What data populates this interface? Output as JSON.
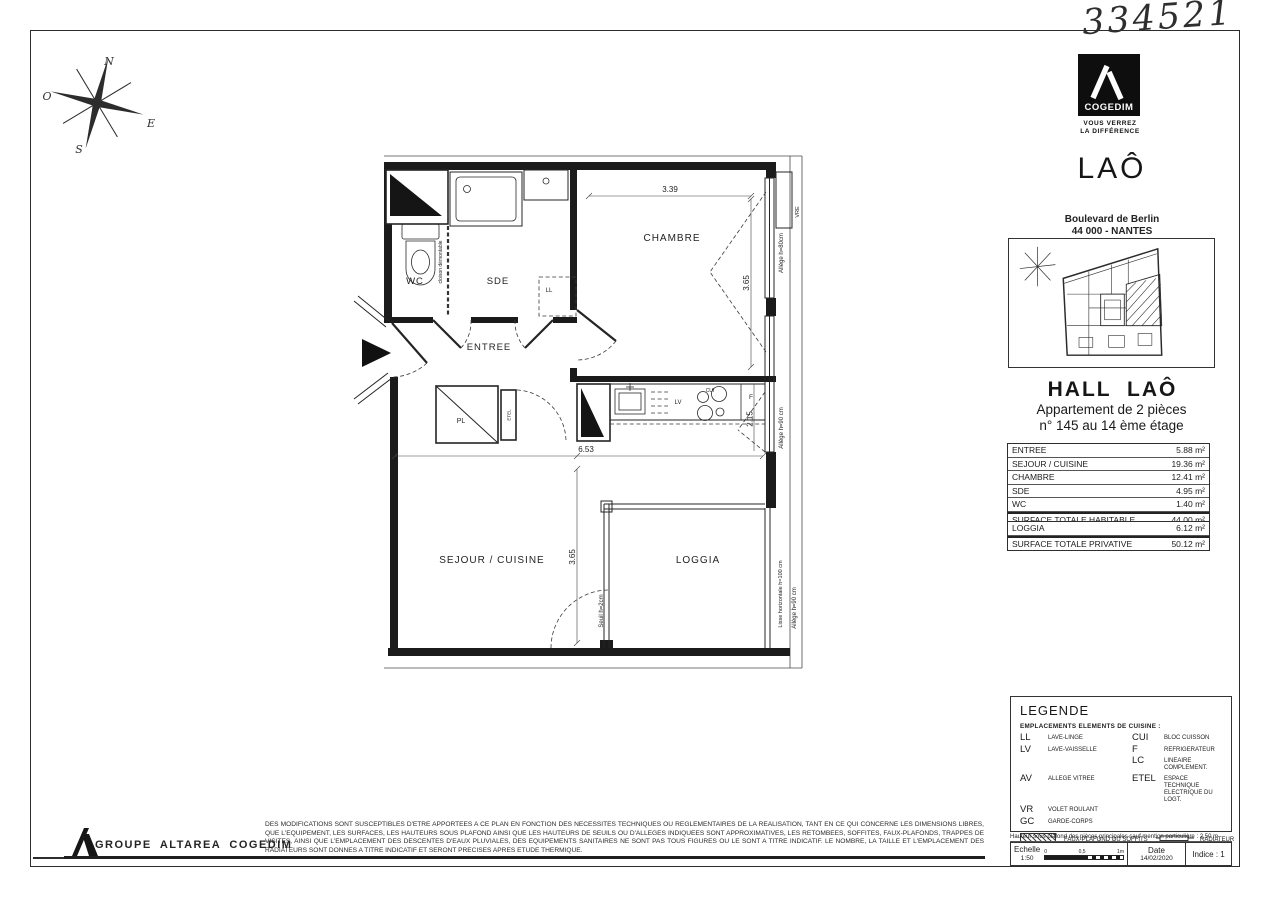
{
  "page": {
    "handwritten_number": "334521"
  },
  "compass": {
    "n": "N",
    "o": "O",
    "e": "E",
    "s": "S"
  },
  "plan": {
    "unit_label": "N°145",
    "rooms": {
      "wc": "WC",
      "sde": "SDE",
      "entree": "ENTREE",
      "chambre": "CHAMBRE",
      "sejour_cuisine": "SEJOUR / CUISINE",
      "loggia": "LOGGIA"
    },
    "fixtures": {
      "ll": "LL",
      "lv": "LV",
      "cui": "CUI",
      "f": "F",
      "pl": "PL",
      "etel": "ETEL",
      "vre": "VRE"
    },
    "annotations": {
      "cloison_demontable": "cloison démontable",
      "allege_80": "Allège h=80cm",
      "allege_90_kitchen": "Allège h=90 cm",
      "allege_90_loggia": "Allège h=90 cm",
      "lisse_horizontale": "Lisse horizontale h=100 cm",
      "seuil": "Seuil h=2cm"
    },
    "dimensions": {
      "chambre_width": "3.39",
      "chambre_height": "3.65",
      "sejour_width": "6.53",
      "kitchen_depth": "2.15",
      "sejour_height": "3.65"
    }
  },
  "sidebar": {
    "logo": {
      "brand": "COGEDIM",
      "tagline1": "VOUS VERREZ",
      "tagline2": "LA DIFFÉRENCE"
    },
    "residence": "LAÔ",
    "address1": "Boulevard de Berlin",
    "address2": "44 000 - NANTES",
    "hall": "HALL LAÔ",
    "apartment1": "Appartement de 2 pièces",
    "apartment2": "n° 145 au 14 ème étage",
    "surface_rows": [
      {
        "label": "ENTREE",
        "value": "5.88 m²"
      },
      {
        "label": "SEJOUR / CUISINE",
        "value": "19.36 m²"
      },
      {
        "label": "CHAMBRE",
        "value": "12.41 m²"
      },
      {
        "label": "SDE",
        "value": "4.95 m²"
      },
      {
        "label": "WC",
        "value": "1.40 m²"
      },
      {
        "label": "SURFACE TOTALE HABITABLE",
        "value": "44.00 m²"
      }
    ],
    "private_rows": [
      {
        "label": "LOGGIA",
        "value": "6.12 m²"
      },
      {
        "label": "SURFACE TOTALE PRIVATIVE",
        "value": "50.12 m²"
      }
    ],
    "legend": {
      "title": "LEGENDE",
      "subtitle": "EMPLACEMENTS ELEMENTS DE CUISINE :",
      "rows": [
        {
          "a": "LL",
          "al": "LAVE-LINGE",
          "b": "CUI",
          "bl": "BLOC CUISSON"
        },
        {
          "a": "LV",
          "al": "LAVE-VAISSELLE",
          "b": "F",
          "bl": "REFRIGERATEUR"
        },
        {
          "a": "",
          "al": "",
          "b": "LC",
          "bl": "LINEAIRE COMPLEMENT."
        },
        {
          "a": "AV",
          "al": "ALLEGE VITREE",
          "b": "ETEL",
          "bl": "ESPACE TECHNIQUE ELECTRIQUE DU LOGT."
        },
        {
          "a": "VR",
          "al": "VOLET ROULANT",
          "b": "",
          "bl": ""
        },
        {
          "a": "GC",
          "al": "GARDE-CORPS",
          "b": "",
          "bl": ""
        }
      ],
      "swatches": {
        "faux_plafond": "FAUX-PLAFOND OU SOFFITS",
        "radiateur": "RADIATEUR",
        "retombee": "RETOMBEE DE POUTRE",
        "seche": "SECHE-SERV."
      }
    },
    "ceiling_note": "Hauteur sous plafond des pièces principales sauf mention particulière : 2,50 m",
    "title_block": {
      "scale_label": "Echelle",
      "scale_value": "1:50",
      "scale_ticks": [
        "0",
        "0,5",
        "1m"
      ],
      "date_label": "Date",
      "date_value": "14/02/2020",
      "indice": "Indice : 1"
    }
  },
  "footer": {
    "company": "GROUPE ALTAREA COGEDIM",
    "disclaimer": "DES MODIFICATIONS SONT SUSCEPTIBLES D'ETRE APPORTEES A CE PLAN EN FONCTION DES NECESSITES TECHNIQUES OU REGLEMENTAIRES DE LA REALISATION, TANT EN CE QUI CONCERNE LES DIMENSIONS LIBRES, QUE L'EQUIPEMENT, LES SURFACES, LES HAUTEURS SOUS PLAFOND AINSI QUE LES HAUTEURS DE SEUILS OU D'ALLEGES INDIQUEES SONT APPROXIMATIVES, LES RETOMBEES, SOFFITES, FAUX-PLAFONDS, TRAPPES DE VISITES, AINSI QUE L'EMPLACEMENT DES DESCENTES D'EAUX PLUVIALES, DES EQUIPEMENTS SANITAIRES NE SONT PAS TOUS FIGURES OU LE SONT A TITRE INDICATIF. LE NOMBRE, LA TAILLE ET L'EMPLACEMENT DES RADIATEURS SONT DONNES A TITRE INDICATIF ET SERONT PRECISES APRES ETUDE THERMIQUE."
  }
}
